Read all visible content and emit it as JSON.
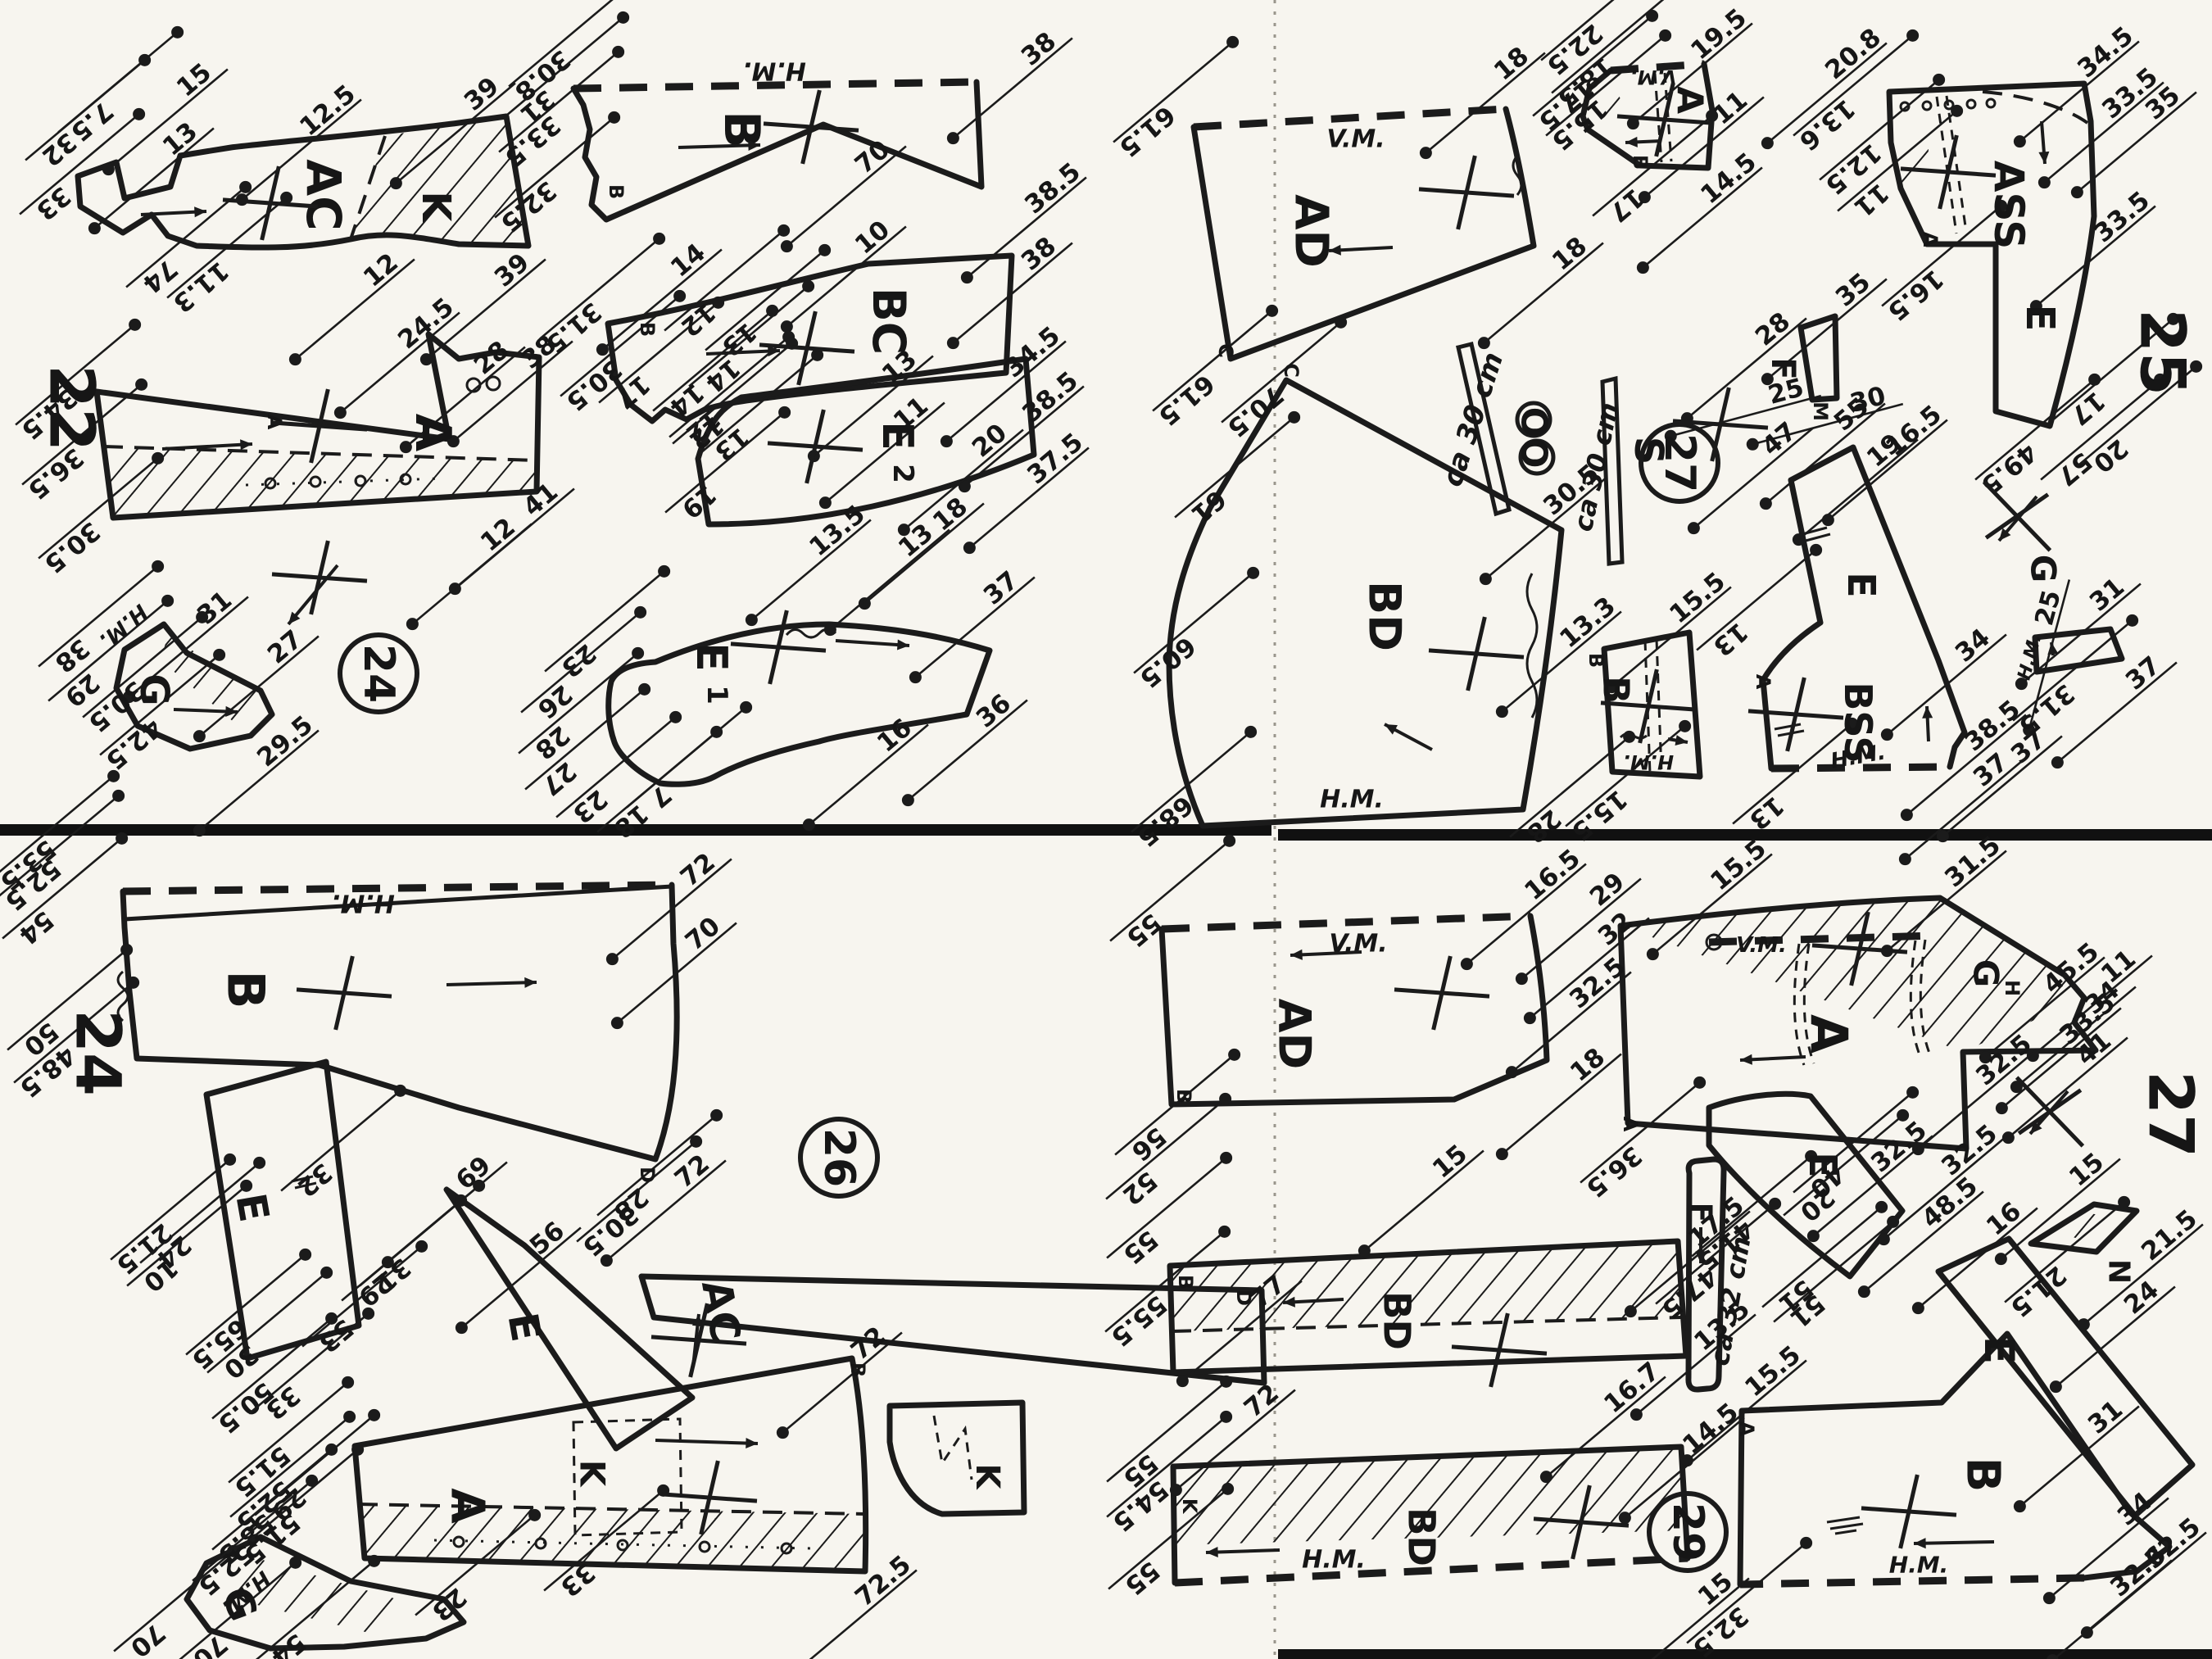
{
  "pages": [
    [
      "22",
      88,
      498
    ],
    [
      "25",
      2640,
      430
    ],
    [
      "24",
      120,
      1285
    ],
    [
      "27",
      2650,
      1360
    ]
  ],
  "circled_numbers": [
    [
      "24",
      462,
      822
    ],
    [
      "27",
      2050,
      565
    ],
    [
      "26",
      1024,
      1413
    ],
    [
      "29",
      2060,
      1870
    ]
  ],
  "piece_labels": [
    [
      "AC",
      395,
      238,
      90,
      58
    ],
    [
      "K",
      532,
      252,
      90,
      48
    ],
    [
      "A",
      528,
      528,
      90,
      60
    ],
    [
      "G",
      188,
      842,
      90,
      48
    ],
    [
      "B",
      905,
      158,
      90,
      60
    ],
    [
      "BC",
      1085,
      392,
      90,
      55
    ],
    [
      "E",
      1095,
      532,
      90,
      52
    ],
    [
      "2",
      1102,
      578,
      90,
      34
    ],
    [
      "E",
      868,
      802,
      90,
      52
    ],
    [
      "1",
      875,
      848,
      90,
      34
    ],
    [
      "AD",
      1600,
      282,
      90,
      56
    ],
    [
      "A",
      2062,
      122,
      90,
      44
    ],
    [
      "ASS",
      2452,
      250,
      90,
      50
    ],
    [
      "E",
      2490,
      388,
      90,
      48
    ],
    [
      "F",
      2176,
      450,
      90,
      40
    ],
    [
      "OO",
      1872,
      534,
      90,
      44
    ],
    [
      "S",
      2012,
      550,
      90,
      48
    ],
    [
      "BD",
      1690,
      752,
      90,
      54
    ],
    [
      "B",
      1972,
      842,
      90,
      44
    ],
    [
      "E",
      2272,
      714,
      90,
      46
    ],
    [
      "BSS",
      2268,
      882,
      90,
      46
    ],
    [
      "G",
      2494,
      694,
      90,
      42
    ],
    [
      "B",
      300,
      1208,
      90,
      62
    ],
    [
      "E",
      308,
      1474,
      80,
      50
    ],
    [
      "E",
      640,
      1620,
      80,
      50
    ],
    [
      "AC",
      880,
      1600,
      80,
      50
    ],
    [
      "A",
      570,
      1838,
      90,
      56
    ],
    [
      "K",
      723,
      1798,
      90,
      42
    ],
    [
      "G",
      292,
      1958,
      70,
      48
    ],
    [
      "K",
      1205,
      1802,
      90,
      40
    ],
    [
      "AD",
      1580,
      1262,
      90,
      54
    ],
    [
      "A",
      2232,
      1262,
      90,
      62
    ],
    [
      "G",
      2424,
      1188,
      90,
      42
    ],
    [
      "E",
      2225,
      1422,
      90,
      46
    ],
    [
      "BD",
      1705,
      1612,
      90,
      45
    ],
    [
      "BD",
      1735,
      1876,
      90,
      45
    ],
    [
      "F",
      2076,
      1480,
      90,
      36
    ],
    [
      "E",
      2440,
      1648,
      90,
      50
    ],
    [
      "B",
      2420,
      1800,
      90,
      56
    ],
    [
      "N",
      2586,
      1552,
      90,
      36
    ]
  ],
  "seam_labels": [
    [
      "H.M.",
      945,
      86,
      180,
      30
    ],
    [
      "H.M.",
      150,
      764,
      140,
      26
    ],
    [
      "V.M.",
      1655,
      170,
      0,
      30
    ],
    [
      "V.M.",
      2018,
      94,
      180,
      24
    ],
    [
      "H.M.",
      1650,
      976,
      0,
      30
    ],
    [
      "H.M.",
      2012,
      930,
      180,
      24
    ],
    [
      "H.M.",
      2268,
      924,
      -10,
      26
    ],
    [
      "H.M.",
      2478,
      802,
      -75,
      22
    ],
    [
      "H.M.",
      443,
      1102,
      180,
      30
    ],
    [
      "H.M.",
      300,
      1944,
      140,
      26
    ],
    [
      "V.M.",
      1658,
      1152,
      0,
      30
    ],
    [
      "V.M.",
      2150,
      1154,
      0,
      26
    ],
    [
      "H.M.",
      1628,
      1904,
      0,
      30
    ],
    [
      "H.M.",
      2342,
      1910,
      0,
      28
    ],
    [
      "ca 30 cm",
      1798,
      512,
      -72,
      34
    ],
    [
      "ca 30 cm",
      1948,
      570,
      -78,
      32
    ],
    [
      "ca 32 cm",
      2112,
      1588,
      -80,
      32
    ]
  ],
  "point_labels": [
    [
      "B",
      752,
      234
    ],
    [
      "B",
      790,
      402
    ],
    [
      "A",
      335,
      515
    ],
    [
      "C",
      1496,
      428
    ],
    [
      "C",
      1576,
      452
    ],
    [
      "B",
      1948,
      806
    ],
    [
      "A",
      2356,
      292
    ],
    [
      "M",
      2222,
      502
    ],
    [
      "B",
      2002,
      198
    ],
    [
      "A",
      2152,
      832
    ],
    [
      "D",
      790,
      1434
    ],
    [
      "D",
      1518,
      1584
    ],
    [
      "B",
      1047,
      1672
    ],
    [
      "B",
      1445,
      1338
    ],
    [
      "B",
      1447,
      1565
    ],
    [
      "K",
      1452,
      1838
    ],
    [
      "A",
      1990,
      1372
    ],
    [
      "H",
      2456,
      1206
    ],
    [
      "A",
      2132,
      1744
    ]
  ],
  "measurements": [
    [
      "15",
      237,
      98,
      -40
    ],
    [
      "13",
      220,
      170,
      -40
    ],
    [
      "12.5",
      400,
      135,
      -40
    ],
    [
      "39",
      588,
      115,
      -40
    ],
    [
      "39",
      625,
      330,
      -40
    ],
    [
      "12",
      465,
      330,
      -40
    ],
    [
      "74",
      195,
      337,
      140
    ],
    [
      "11.3",
      245,
      350,
      140
    ],
    [
      "7.5",
      112,
      148,
      140
    ],
    [
      "32",
      72,
      182,
      140
    ],
    [
      "33",
      65,
      248,
      140
    ],
    [
      "24.5",
      520,
      395,
      -40
    ],
    [
      "28",
      600,
      437,
      -40
    ],
    [
      "38",
      658,
      430,
      -40
    ],
    [
      "41",
      660,
      610,
      -40
    ],
    [
      "12",
      608,
      653,
      -40
    ],
    [
      "34.5",
      60,
      505,
      140
    ],
    [
      "36.5",
      68,
      578,
      140
    ],
    [
      "30.5",
      88,
      668,
      140
    ],
    [
      "31",
      262,
      742,
      -40
    ],
    [
      "27",
      348,
      790,
      -40
    ],
    [
      "29.5",
      348,
      905,
      -40
    ],
    [
      "38",
      88,
      800,
      140
    ],
    [
      "29",
      100,
      842,
      140
    ],
    [
      "30.5",
      142,
      862,
      140
    ],
    [
      "42.5",
      163,
      908,
      140
    ],
    [
      "38",
      1268,
      60,
      -40
    ],
    [
      "38.5",
      1285,
      230,
      -40
    ],
    [
      "70",
      1065,
      192,
      -40
    ],
    [
      "30.8",
      662,
      92,
      140
    ],
    [
      "31",
      656,
      130,
      140
    ],
    [
      "33.5",
      650,
      172,
      140
    ],
    [
      "32.5",
      645,
      252,
      140
    ],
    [
      "14",
      840,
      318,
      -40
    ],
    [
      "10",
      1065,
      290,
      -40
    ],
    [
      "38",
      1268,
      310,
      -40
    ],
    [
      "38.5",
      1282,
      485,
      -40
    ],
    [
      "11",
      1112,
      505,
      -40
    ],
    [
      "20",
      1208,
      538,
      -40
    ],
    [
      "31.5",
      700,
      400,
      140
    ],
    [
      "30.5",
      725,
      470,
      140
    ],
    [
      "17",
      772,
      478,
      140
    ],
    [
      "14",
      838,
      488,
      140
    ],
    [
      "12",
      858,
      520,
      140
    ],
    [
      "13",
      893,
      542,
      140
    ],
    [
      "13",
      1098,
      448,
      -40
    ],
    [
      "34.5",
      1260,
      430,
      -40
    ],
    [
      "37.5",
      1288,
      560,
      -40
    ],
    [
      "18",
      1160,
      628,
      -40
    ],
    [
      "13",
      1118,
      660,
      -40
    ],
    [
      "19",
      853,
      612,
      140
    ],
    [
      "12",
      862,
      528,
      140
    ],
    [
      "14",
      882,
      458,
      140
    ],
    [
      "13",
      902,
      414,
      140
    ],
    [
      "12",
      852,
      390,
      140
    ],
    [
      "13.5",
      1022,
      648,
      -40
    ],
    [
      "37",
      1222,
      718,
      -40
    ],
    [
      "36",
      1213,
      868,
      -40
    ],
    [
      "16",
      1092,
      898,
      -40
    ],
    [
      "23",
      706,
      806,
      140
    ],
    [
      "26",
      677,
      856,
      140
    ],
    [
      "28",
      674,
      906,
      140
    ],
    [
      "27",
      682,
      950,
      140
    ],
    [
      "23",
      720,
      984,
      140
    ],
    [
      "18",
      770,
      1002,
      140
    ],
    [
      "7",
      806,
      972,
      140
    ],
    [
      "18",
      1845,
      78,
      -40
    ],
    [
      "18",
      1916,
      310,
      -40
    ],
    [
      "61.5",
      1400,
      160,
      140
    ],
    [
      "61.5",
      1448,
      488,
      140
    ],
    [
      "70.5",
      1532,
      502,
      140
    ],
    [
      "19.5",
      2098,
      42,
      -40
    ],
    [
      "11",
      2112,
      132,
      -40
    ],
    [
      "14.5",
      2110,
      218,
      -40
    ],
    [
      "22.5",
      1922,
      60,
      140
    ],
    [
      "18.5",
      1935,
      100,
      140
    ],
    [
      "17.5",
      1912,
      128,
      140
    ],
    [
      "15.5",
      1928,
      152,
      140
    ],
    [
      "17",
      1985,
      250,
      140
    ],
    [
      "20.8",
      2262,
      66,
      -40
    ],
    [
      "34.5",
      2570,
      64,
      -40
    ],
    [
      "33.5",
      2600,
      114,
      -40
    ],
    [
      "35",
      2640,
      126,
      -40
    ],
    [
      "33.5",
      2590,
      265,
      -40
    ],
    [
      "13.6",
      2230,
      152,
      140
    ],
    [
      "12.5",
      2262,
      206,
      140
    ],
    [
      "11",
      2284,
      244,
      140
    ],
    [
      "16.5",
      2338,
      360,
      140
    ],
    [
      "49.5",
      2452,
      572,
      140
    ],
    [
      "57",
      2532,
      572,
      140
    ],
    [
      "20",
      2576,
      556,
      140
    ],
    [
      "17",
      2548,
      498,
      140
    ],
    [
      "28",
      2164,
      402,
      -40
    ],
    [
      "35",
      2262,
      354,
      -40
    ],
    [
      "25",
      2180,
      478,
      -15
    ],
    [
      "30",
      2280,
      488,
      -15
    ],
    [
      "30.5",
      1918,
      598,
      -40
    ],
    [
      "13.3",
      1938,
      760,
      -40
    ],
    [
      "61",
      1475,
      618,
      140
    ],
    [
      "60.5",
      1425,
      808,
      140
    ],
    [
      "68.5",
      1422,
      1002,
      140
    ],
    [
      "28",
      1884,
      1008,
      140
    ],
    [
      "15.5",
      2072,
      730,
      -40
    ],
    [
      "15.5",
      1952,
      995,
      140
    ],
    [
      "47",
      2172,
      536,
      -40
    ],
    [
      "55",
      2260,
      506,
      -40
    ],
    [
      "19",
      2300,
      550,
      -40
    ],
    [
      "16.5",
      2336,
      526,
      -40
    ],
    [
      "34",
      2408,
      788,
      -40
    ],
    [
      "38.5",
      2432,
      886,
      -40
    ],
    [
      "37",
      2476,
      912,
      -40
    ],
    [
      "37",
      2430,
      940,
      -40
    ],
    [
      "13",
      2112,
      780,
      140
    ],
    [
      "13",
      2156,
      992,
      140
    ],
    [
      "25",
      2500,
      742,
      -75
    ],
    [
      "31",
      2572,
      726,
      -40
    ],
    [
      "37",
      2616,
      822,
      -40
    ],
    [
      "31.5",
      2498,
      866,
      140
    ],
    [
      "72",
      852,
      1062,
      -40
    ],
    [
      "70",
      858,
      1140,
      -40
    ],
    [
      "72",
      845,
      1430,
      -40
    ],
    [
      "53.5",
      34,
      1056,
      140
    ],
    [
      "52.5",
      40,
      1080,
      140
    ],
    [
      "54",
      44,
      1132,
      140
    ],
    [
      "50",
      50,
      1268,
      140
    ],
    [
      "48.5",
      58,
      1308,
      140
    ],
    [
      "32",
      384,
      1440,
      140
    ],
    [
      "21.5",
      176,
      1524,
      140
    ],
    [
      "24",
      212,
      1528,
      140
    ],
    [
      "10",
      196,
      1556,
      140
    ],
    [
      "65.5",
      268,
      1640,
      140
    ],
    [
      "30",
      294,
      1662,
      140
    ],
    [
      "53",
      410,
      1630,
      140
    ],
    [
      "69",
      578,
      1432,
      -40
    ],
    [
      "56",
      668,
      1512,
      -40
    ],
    [
      "29",
      458,
      1574,
      140
    ],
    [
      "31",
      480,
      1556,
      140
    ],
    [
      "33",
      705,
      1928,
      140
    ],
    [
      "30.5",
      745,
      1502,
      140
    ],
    [
      "28",
      770,
      1470,
      140
    ],
    [
      "77",
      1548,
      1577,
      -40
    ],
    [
      "72",
      1540,
      1710,
      -40
    ],
    [
      "72",
      1060,
      1640,
      -40
    ],
    [
      "72.5",
      1078,
      1930,
      -40
    ],
    [
      "23",
      548,
      1958,
      140
    ],
    [
      "54",
      352,
      2014,
      140
    ],
    [
      "70",
      256,
      2016,
      140
    ],
    [
      "70",
      180,
      2002,
      140
    ],
    [
      "50.5",
      300,
      1718,
      140
    ],
    [
      "33",
      345,
      1712,
      140
    ],
    [
      "51.5",
      320,
      1796,
      140
    ],
    [
      "52.5",
      322,
      1838,
      140
    ],
    [
      "29",
      352,
      1836,
      140
    ],
    [
      "58.5",
      300,
      1878,
      140
    ],
    [
      "51.5",
      332,
      1878,
      140
    ],
    [
      "52.5",
      276,
      1916,
      140
    ],
    [
      "16.5",
      1895,
      1068,
      -40
    ],
    [
      "18",
      1938,
      1300,
      -40
    ],
    [
      "15",
      1770,
      1418,
      -40
    ],
    [
      "55",
      1396,
      1135,
      140
    ],
    [
      "56",
      1402,
      1396,
      140
    ],
    [
      "15.5",
      2122,
      1056,
      -40
    ],
    [
      "31.5",
      2408,
      1052,
      -40
    ],
    [
      "45.5",
      2528,
      1182,
      -40
    ],
    [
      "11",
      2586,
      1180,
      -40
    ],
    [
      "34",
      2566,
      1218,
      -40
    ],
    [
      "33.5",
      2548,
      1244,
      -40
    ],
    [
      "41",
      2556,
      1280,
      -40
    ],
    [
      "32.5",
      2446,
      1294,
      -40
    ],
    [
      "32.5",
      2404,
      1404,
      -40
    ],
    [
      "29",
      1962,
      1086,
      -40
    ],
    [
      "32",
      1972,
      1134,
      -40
    ],
    [
      "32.5",
      1950,
      1200,
      -40
    ],
    [
      "36.5",
      1970,
      1430,
      140
    ],
    [
      "41.5",
      2106,
      1520,
      140
    ],
    [
      "51",
      2206,
      1600,
      140
    ],
    [
      "47.5",
      2062,
      1578,
      140
    ],
    [
      "40",
      2230,
      1442,
      140
    ],
    [
      "20",
      2218,
      1470,
      140
    ],
    [
      "48.5",
      2380,
      1468,
      -40
    ],
    [
      "32.5",
      2318,
      1400,
      -40
    ],
    [
      "16",
      2446,
      1488,
      -40
    ],
    [
      "31",
      2570,
      1730,
      -40
    ],
    [
      "34",
      2606,
      1842,
      -40
    ],
    [
      "32.5",
      2652,
      1884,
      -40
    ],
    [
      "32.6",
      2610,
      1918,
      -40
    ],
    [
      "51",
      2192,
      1582,
      140
    ],
    [
      "15.5",
      2164,
      1674,
      -40
    ],
    [
      "32.5",
      2100,
      1992,
      140
    ],
    [
      "15",
      2547,
      1428,
      -40
    ],
    [
      "21.5",
      2648,
      1508,
      -40
    ],
    [
      "21.5",
      2488,
      1576,
      140
    ],
    [
      "24",
      2614,
      1584,
      -40
    ],
    [
      "17.5",
      2095,
      1492,
      -40
    ],
    [
      "13.5",
      2102,
      1618,
      -40
    ],
    [
      "16.7",
      1992,
      1694,
      -40
    ],
    [
      "52",
      1391,
      1450,
      140
    ],
    [
      "55",
      1392,
      1522,
      140
    ],
    [
      "55.5",
      1390,
      1612,
      140
    ],
    [
      "14.5",
      2088,
      1744,
      -40
    ],
    [
      "15",
      2094,
      1940,
      -40
    ],
    [
      "55",
      1392,
      1795,
      140
    ],
    [
      "54.5",
      1392,
      1838,
      140
    ],
    [
      "55",
      1394,
      1926,
      140
    ]
  ],
  "crosses": [
    [
      330,
      248
    ],
    [
      390,
      520
    ],
    [
      990,
      155
    ],
    [
      985,
      425
    ],
    [
      995,
      545
    ],
    [
      950,
      790
    ],
    [
      390,
      705
    ],
    [
      1790,
      235
    ],
    [
      2032,
      146
    ],
    [
      2378,
      210
    ],
    [
      2100,
      518
    ],
    [
      1802,
      798
    ],
    [
      2012,
      862
    ],
    [
      2192,
      872
    ],
    [
      2462,
      630,
      "x"
    ],
    [
      420,
      1212
    ],
    [
      866,
      1828
    ],
    [
      853,
      1636
    ],
    [
      1760,
      1212
    ],
    [
      1830,
      1648
    ],
    [
      1930,
      1858
    ],
    [
      2270,
      1158
    ],
    [
      2330,
      1845
    ],
    [
      2502,
      1357,
      "x"
    ]
  ],
  "arrows": [
    [
      172,
      262,
      252,
      258
    ],
    [
      198,
      548,
      308,
      542
    ],
    [
      412,
      690,
      352,
      762
    ],
    [
      212,
      866,
      290,
      869
    ],
    [
      828,
      180,
      928,
      177
    ],
    [
      862,
      432,
      952,
      428
    ],
    [
      1020,
      782,
      1110,
      788
    ],
    [
      1700,
      302,
      1622,
      306
    ],
    [
      2028,
      172,
      1984,
      174
    ],
    [
      2492,
      148,
      2496,
      200
    ],
    [
      1748,
      915,
      1690,
      884
    ],
    [
      2036,
      902,
      2060,
      906
    ],
    [
      2354,
      905,
      2352,
      862
    ],
    [
      2506,
      800,
      2504,
      784
    ],
    [
      2486,
      606,
      2440,
      660
    ],
    [
      545,
      1202,
      655,
      1199
    ],
    [
      800,
      1758,
      925,
      1762
    ],
    [
      846,
      1668,
      853,
      1604
    ],
    [
      1662,
      1162,
      1575,
      1166
    ],
    [
      1640,
      1586,
      1566,
      1590
    ],
    [
      1562,
      1892,
      1472,
      1895
    ],
    [
      2204,
      1290,
      2124,
      1294
    ],
    [
      2434,
      1882,
      2336,
      1884
    ],
    [
      2076,
      1498,
      2076,
      1542
    ],
    [
      2524,
      1332,
      2478,
      1384
    ]
  ]
}
